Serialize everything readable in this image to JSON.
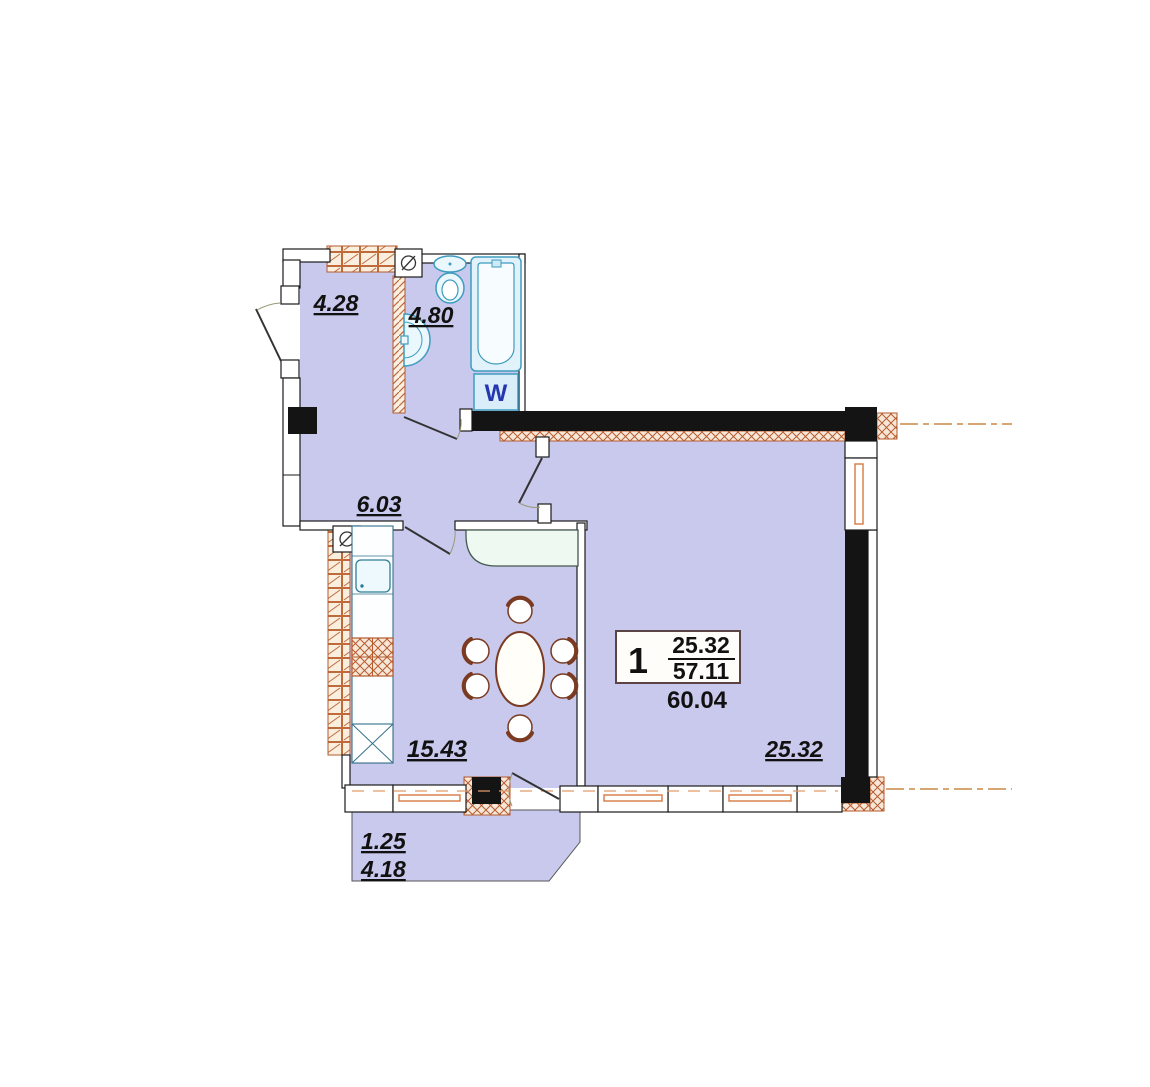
{
  "plan": {
    "rooms": {
      "hallway_area": "4.28",
      "bathroom_area": "4.80",
      "hall_area": "6.03",
      "kitchen_area": "15.43",
      "living_area": "25.32",
      "balcony_reduced_area": "1.25",
      "balcony_area": "4.18"
    },
    "info_box": {
      "room_count": "1",
      "living_area": "25.32",
      "total_area": "57.11",
      "overall_area": "60.04"
    },
    "fixtures": {
      "washing_machine_label": "W"
    },
    "colors": {
      "floor": "#c9c9ed",
      "wall_black": "#141414",
      "hatch_orange": "#b55a2e",
      "window_frame_orange": "#d8824e",
      "fixture_cyan": "#3e9cbf",
      "washer_label_blue": "#2636b0",
      "furniture_brown": "#7a3b22",
      "centerline_orange": "#cc8844"
    }
  }
}
